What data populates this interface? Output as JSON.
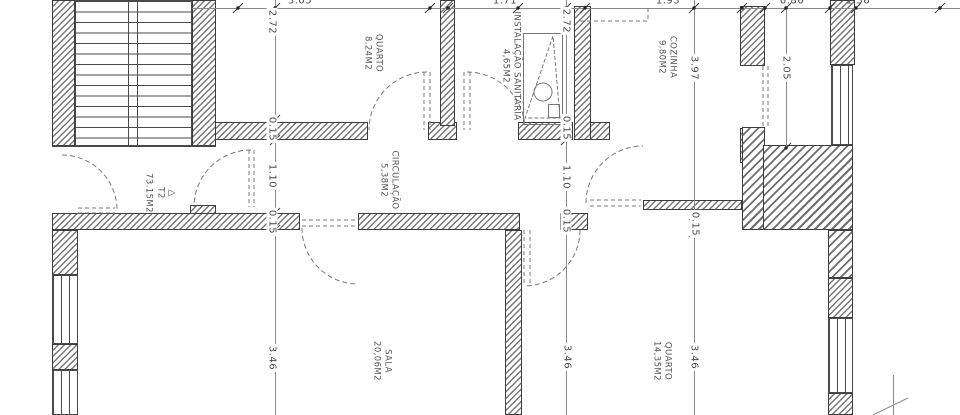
{
  "drawing": {
    "unit": {
      "symbol": "△",
      "type": "T2",
      "area": "73.15M2"
    },
    "rooms": [
      {
        "name": "QUARTO",
        "area": "8.24M2"
      },
      {
        "name": "INSTALAÇÃO SANITÁRIA",
        "area": "4,65M2"
      },
      {
        "name": "COZINHA",
        "area": "9.80M2"
      },
      {
        "name": "CIRCULAÇÃO",
        "area": "5,38M2"
      },
      {
        "name": "SALA",
        "area": "20,06M2"
      },
      {
        "name": "QUARTO",
        "area": "14,35M2"
      }
    ],
    "dims": {
      "top": [
        "3.05",
        "1.71",
        "1.93",
        "0.86",
        "1.36"
      ],
      "col1": [
        "2.72",
        "0.15",
        "1.10",
        "0.15",
        "3.46"
      ],
      "col2": [
        "2.72",
        "0.15",
        "1.10",
        "0.15",
        "3.46"
      ],
      "col3": [
        "3.97",
        "0.15",
        "3.46"
      ],
      "col4": [
        "2.05"
      ]
    }
  }
}
